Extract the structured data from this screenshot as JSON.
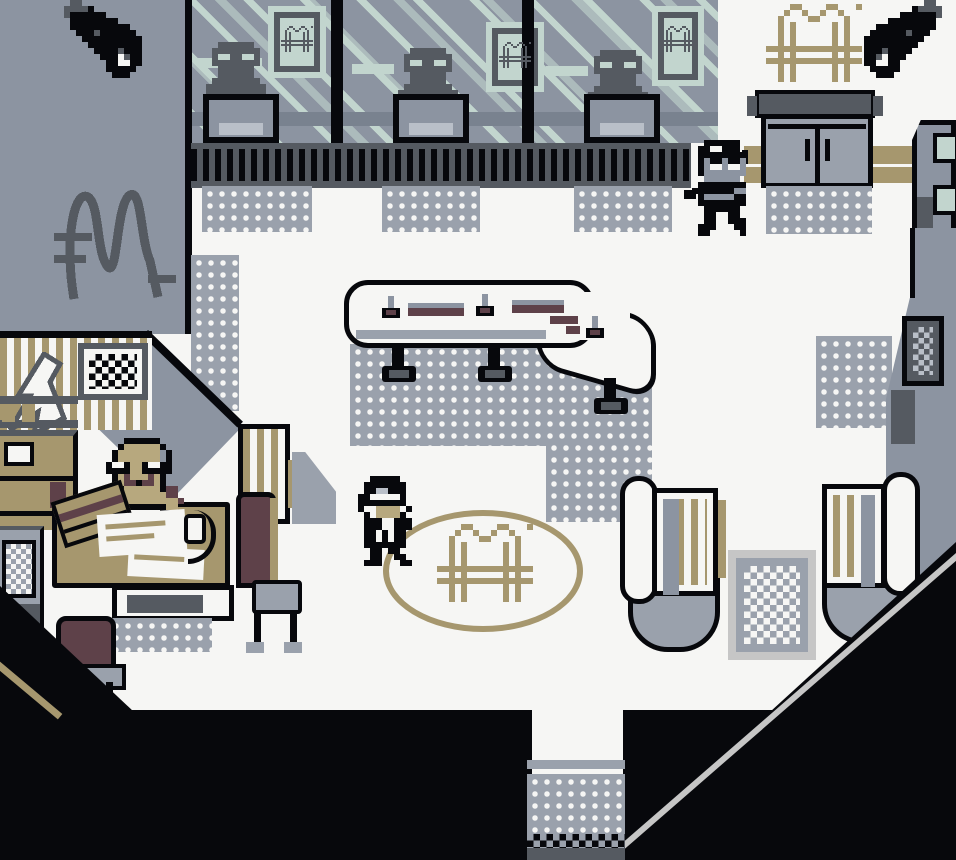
{
  "meta": {
    "scene": "pixel-art bank lobby",
    "visible_text": "none"
  },
  "palette": {
    "k": "#07080c",
    "d": "#555a61",
    "s": "#8c94a1",
    "g": "#9aa1ac",
    "l": "#b9bfc8",
    "m": "#c2d5ce",
    "w": "#f6f6f4",
    "t": "#a6976e",
    "r": "#5e4149",
    "f": "#b7a87e",
    "c": "#c6c6c6",
    "v": "#79828f"
  },
  "sprites": {
    "logo_m": {
      "rows": [
        "....tt....tt...t",
        "...t..t..t..t...",
        "..t....tt....t..",
        "..t.t......t.t..",
        "..t.t......t.t..",
        "..t.t......t.t..",
        "..t.t......t.t..",
        "tttttttttttttttt",
        "..t.t......t.t..",
        "tttttttttttttttt",
        "..t.t......t.t..",
        "..t.t......t.t..",
        "..t.t......t.t.."
      ]
    },
    "teller": {
      "rows": [
        "..dddddd..",
        ".dddddddd.",
        ".dmmddmmd.",
        ".dddddddd.",
        "..dddddd..",
        "..dddddd..",
        ".dddddddd.",
        "dddddddddd",
        "dddddddddd"
      ]
    },
    "ninja": {
      "rows": [
        "..kkkkkk..",
        ".kkwwkkk..",
        ".kkkkkkkk.",
        ".kskkskks.",
        ".kswwswws.",
        ".ksssssss.",
        "..ssssss..",
        ".kkkkkkkk.",
        "kkkkkkkss.",
        ".kssssskk.",
        ".kkkkkkkk.",
        "..kkkkkk..",
        "..kk..kk..",
        "..kk..kkk.",
        ".kkk...kk.",
        ".kk.....k."
      ]
    },
    "suit": {
      "rows": [
        "...kkkkk...",
        "..kkkkkkk..",
        "..kkllkkk..",
        ".kkwwwwwk..",
        ".kkkkkkkkw.",
        ".kwwffffwk.",
        "..kwffffk..",
        "..kkkwwkkk.",
        ".wkkkwwkkk.",
        "..kkwkwkk..",
        "..kkwkwkk..",
        "..kkkkkkk..",
        "...kk.kk...",
        "...kk..kk..",
        "..kkk...kk."
      ]
    },
    "manager": {
      "rows": [
        ".....kkkkkk.....",
        "....kffffffk....",
        "...kfffffffsk...",
        "...kfffffffsk...",
        "..kwwkffkwwkk...",
        "..kkkkffkkkkk...",
        "...kfrfffrfk....",
        "...kfrrkrrfk....",
        "..rrkffffffkrr..",
        ".rrfffffffffrr..",
        ".rffffffffffffr.",
        "..ffkkkkkkkkff..",
        "...kkwwwwwwkk..."
      ]
    },
    "camera": {
      "rows": [
        "...dd...........",
        "..ddddk.........",
        "..dkkkkkk.......",
        "...kkkkkkkk.....",
        "...kkkkkkkkkk...",
        "....kkkdkkkkkk..",
        ".....kkkkkkkkkk.",
        "......kkkkkkkkk.",
        ".......kkkkdkkk.",
        "........kkkwdkk.",
        ".........kkwwkk.",
        ".........kkkkk..",
        "..........kkk..."
      ]
    }
  },
  "entities": [
    {
      "name": "security-camera-left",
      "sprite": "camera",
      "x": 52,
      "y": 0,
      "cell": 6,
      "interactable": true
    },
    {
      "name": "security-camera-right",
      "sprite": "camera",
      "x": 858,
      "y": 0,
      "cell": 6,
      "flip": true,
      "interactable": true
    },
    {
      "name": "frame-logo-1",
      "sprite": "logo_m",
      "x": 281,
      "y": 26,
      "cell": 2,
      "tint": "d",
      "interactable": false
    },
    {
      "name": "frame-logo-2",
      "sprite": "logo_m",
      "x": 499,
      "y": 42,
      "cell": 2,
      "tint": "d",
      "interactable": false
    },
    {
      "name": "frame-logo-3",
      "sprite": "logo_m",
      "x": 662,
      "y": 26,
      "cell": 2,
      "tint": "d",
      "interactable": false
    },
    {
      "name": "teller-npc-1",
      "sprite": "teller",
      "x": 206,
      "y": 42,
      "cell": 6,
      "interactable": true
    },
    {
      "name": "teller-npc-2",
      "sprite": "teller",
      "x": 398,
      "y": 48,
      "cell": 6,
      "interactable": true
    },
    {
      "name": "teller-npc-3",
      "sprite": "teller",
      "x": 588,
      "y": 50,
      "cell": 6,
      "interactable": true
    },
    {
      "name": "wall-logo-m",
      "sprite": "logo_m",
      "x": 766,
      "y": 4,
      "cell": 6,
      "interactable": false
    },
    {
      "name": "ninja-npc",
      "sprite": "ninja",
      "x": 692,
      "y": 140,
      "cell": 6,
      "interactable": true
    },
    {
      "name": "floor-logo-m",
      "sprite": "logo_m",
      "x": 437,
      "y": 524,
      "cell": 6,
      "interactable": false
    },
    {
      "name": "player-character-suit",
      "sprite": "suit",
      "x": 352,
      "y": 476,
      "cell": 6,
      "interactable": true
    },
    {
      "name": "manager-npc",
      "sprite": "manager",
      "x": 94,
      "y": 438,
      "cell": 6,
      "interactable": true
    }
  ]
}
